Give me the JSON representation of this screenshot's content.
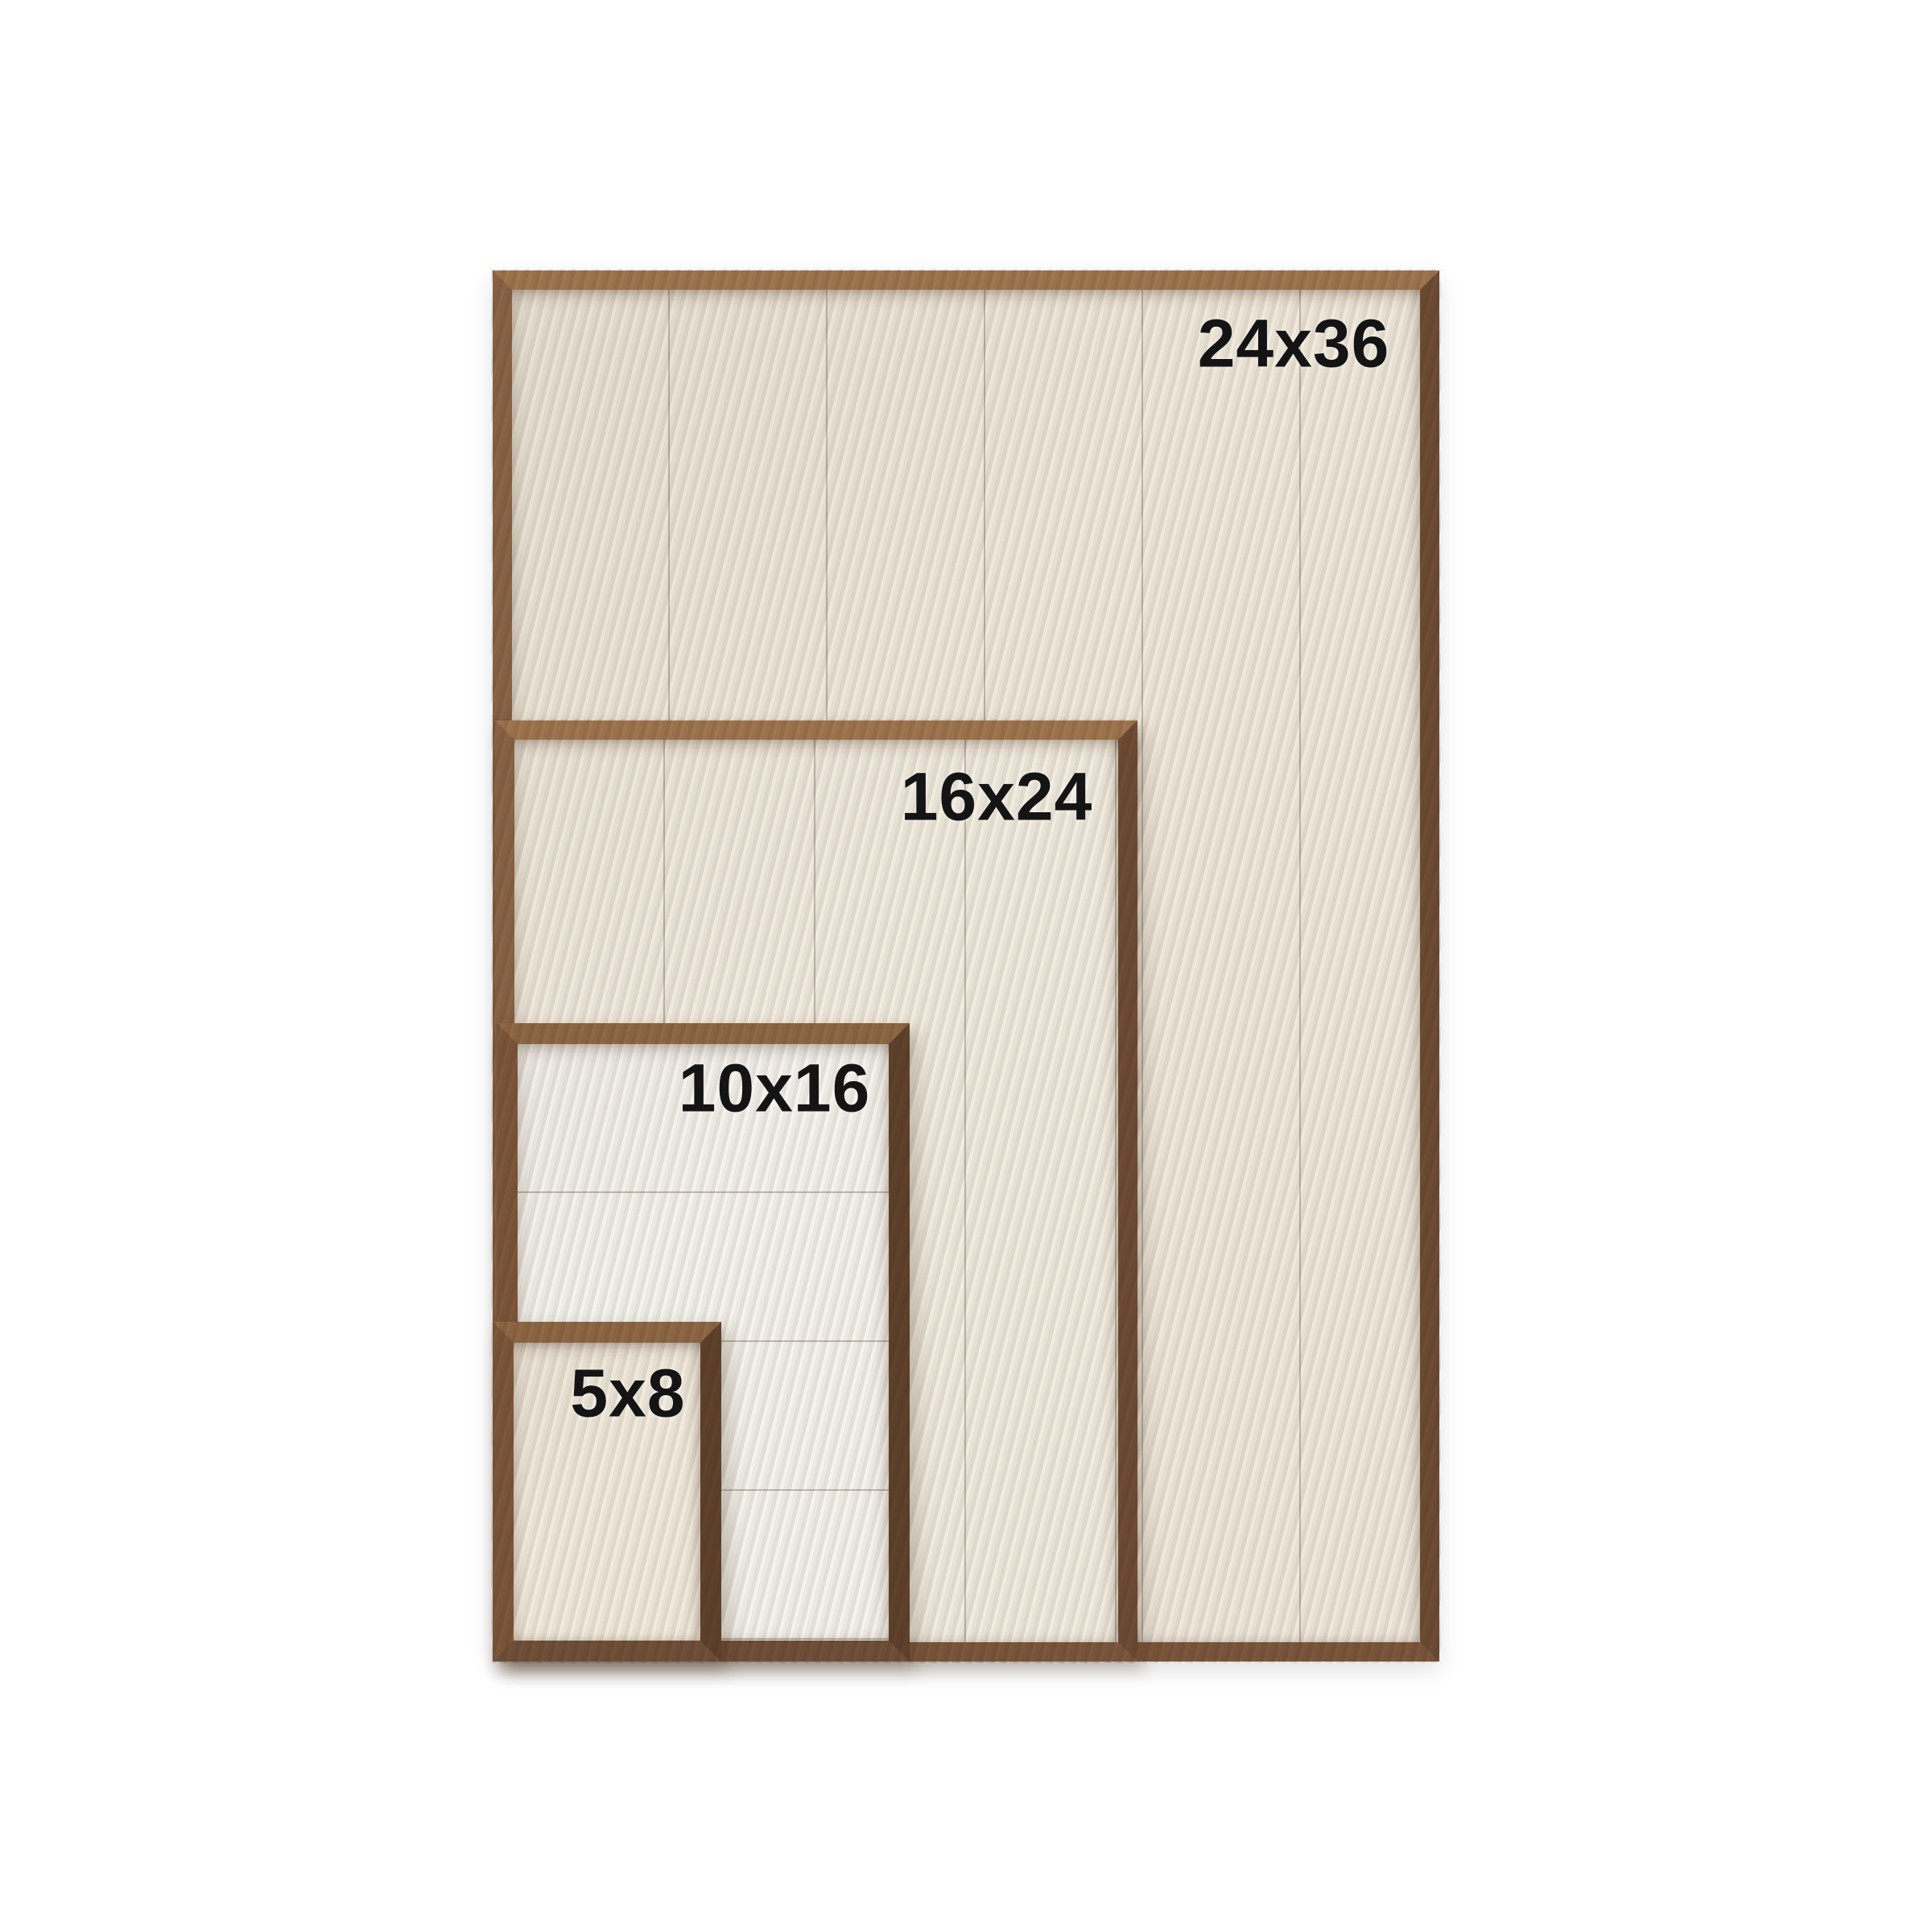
{
  "scene": {
    "description": "Size comparison of nested rustic wood framed shiplap signs on a white background",
    "background_color": "#ffffff",
    "label_text_color": "#141414",
    "wood_color": "#8a6446",
    "wood_color_dark_edge": "#6e4c34",
    "wood_color_light_edge": "#9f764f"
  },
  "frames": [
    {
      "label": "24x36",
      "planks": "vertical",
      "plank_count": 6,
      "interior_color": "#f0eadd"
    },
    {
      "label": "16x24",
      "planks": "vertical",
      "plank_count": 4,
      "interior_color": "#f2ede1"
    },
    {
      "label": "10x16",
      "planks": "horizontal",
      "plank_count": 4,
      "interior_color": "#f6f4f0"
    },
    {
      "label": "5x8",
      "planks": "none",
      "plank_count": 1,
      "interior_color": "#f2ecdf"
    }
  ]
}
